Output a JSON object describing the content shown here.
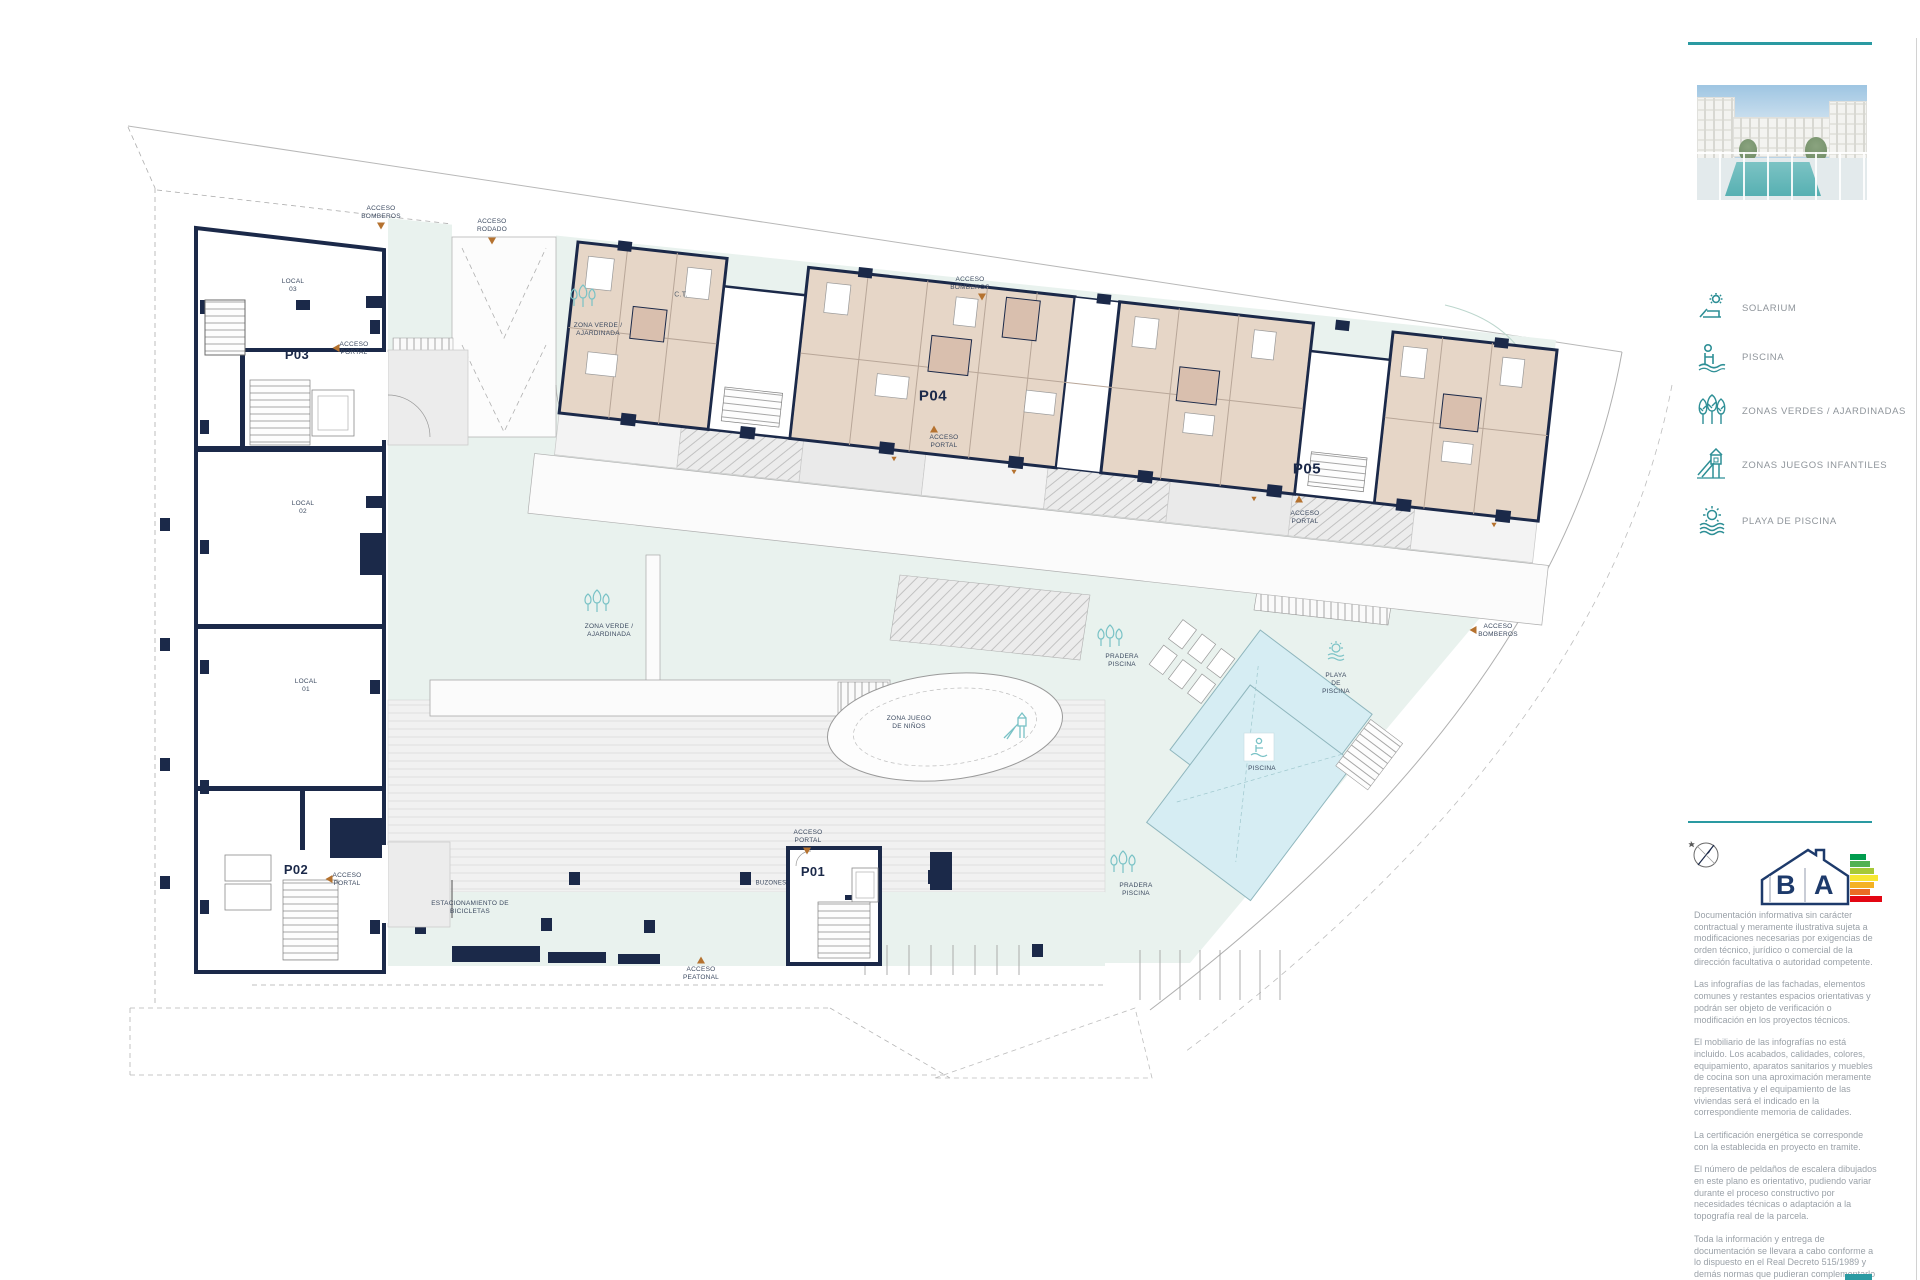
{
  "plan": {
    "labels": {
      "acceso_bomberos_tl": "ACCESO\nBOMBEROS",
      "acceso_rodado": "ACCESO\nRODADO",
      "zona_verde_top": "ZONA VERDE /\nAJARDINADA",
      "ct": "C.T.",
      "acceso_bomberos_top": "ACCESO\nBOMBEROS",
      "p04": "P04",
      "acceso_portal_p04": "ACCESO\nPORTAL",
      "p05": "P05",
      "acceso_portal_p05": "ACCESO\nPORTAL",
      "p03": "P03",
      "local_03": "LOCAL\n03",
      "acceso_portal_p03": "ACCESO\nPORTAL",
      "local_02": "LOCAL\n02",
      "local_01": "LOCAL\n01",
      "p02": "P02",
      "acceso_portal_p02": "ACCESO\nPORTAL",
      "estacionamiento": "ESTACIONAMIENTO DE\nBICICLETAS",
      "p01": "P01",
      "acceso_portal_p01": "ACCESO\nPORTAL",
      "buzones": "BUZONES",
      "zona_verde_center": "ZONA VERDE /\nAJARDINADA",
      "zona_juego": "ZONA JUEGO\nDE NIÑOS",
      "pradera_1": "PRADERA\nPISCINA",
      "playa": "PLAYA\nDE\nPISCINA",
      "piscina": "PISCINA",
      "pradera_2": "PRADERA\nPISCINA",
      "acceso_bomberos_right": "ACCESO\nBOMBEROS",
      "acceso_peatonal": "ACCESO\nPEATONAL"
    },
    "colors": {
      "wall_navy": "#1b2949",
      "apartment_beige": "#e6d6c7",
      "green_zone_mint": "#e9f2ee",
      "pool_blue": "#d6edf3",
      "marker_orange": "#b5722f",
      "accent_teal": "#2a9aa2"
    }
  },
  "sidebar": {
    "legend": {
      "items": [
        {
          "label": "SOLARIUM",
          "icon": "solarium-icon"
        },
        {
          "label": "PISCINA",
          "icon": "swimmer-icon"
        },
        {
          "label": "ZONAS VERDES / AJARDINADAS",
          "icon": "trees-icon"
        },
        {
          "label": "ZONAS JUEGOS INFANTILES",
          "icon": "slide-icon"
        },
        {
          "label": "PLAYA DE PISCINA",
          "icon": "sun-waves-icon"
        }
      ]
    },
    "energy_logo": {
      "letter_b": "B",
      "letter_a": "A"
    },
    "disclaimer": {
      "paragraphs": [
        "Documentación informativa sin carácter contractual y meramente ilustrativa sujeta a modificaciones necesarias por exigencias de orden técnico, jurídico o comercial de la dirección facultativa o autoridad competente.",
        "Las infografías de las fachadas, elementos comunes y restantes espacios orientativas y podrán ser objeto de verificación o modificación en los proyectos técnicos.",
        "El mobiliario de las infografías no está incluido. Los acabados, calidades, colores, equipamiento, aparatos sanitarios y muebles de cocina son una aproximación meramente representativa y el equipamiento de las viviendas será el indicado en la correspondiente memoria de calidades.",
        "La certificación energética se corresponde con la establecida en proyecto en tramite.",
        "El número de peldaños de escalera dibujados en este plano es orientativo, pudiendo variar durante el proceso constructivo por necesidades técnicas o adaptación a la topografía real de la parcela.",
        "Toda la información y entrega de documentación se llevara a cabo conforme a lo dispuesto en el Real Decreto 515/1989 y demás normas que pudieran complementarlo ya sean de carácter estatal o autonómico."
      ]
    }
  }
}
